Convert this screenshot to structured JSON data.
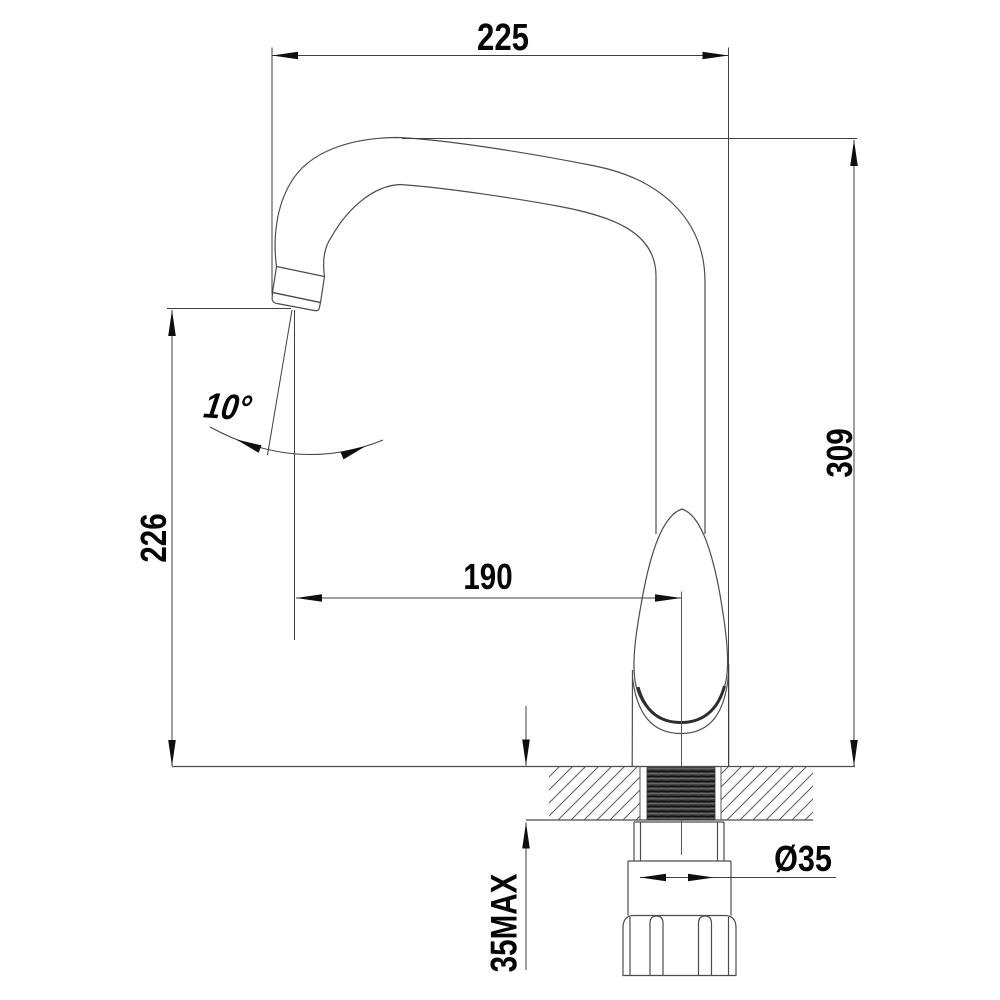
{
  "drawing": {
    "type": "technical-dimension-drawing",
    "subject": "kitchen-faucet-side-view",
    "dimensions": {
      "spout_width_top": "225",
      "overall_height_right": "309",
      "spout_outlet_height_left": "226",
      "outlet_to_center_width": "190",
      "stream_angle": "10°",
      "shank_diameter": "Ø35",
      "counter_max_thickness": "35MAX"
    },
    "colors": {
      "background": "#ffffff",
      "outline": "#4c4c4c",
      "dimension_lines": "#3f3f3f",
      "arrows_text": "#0f0f0f",
      "thread_fill": "#3f3f3f"
    }
  }
}
